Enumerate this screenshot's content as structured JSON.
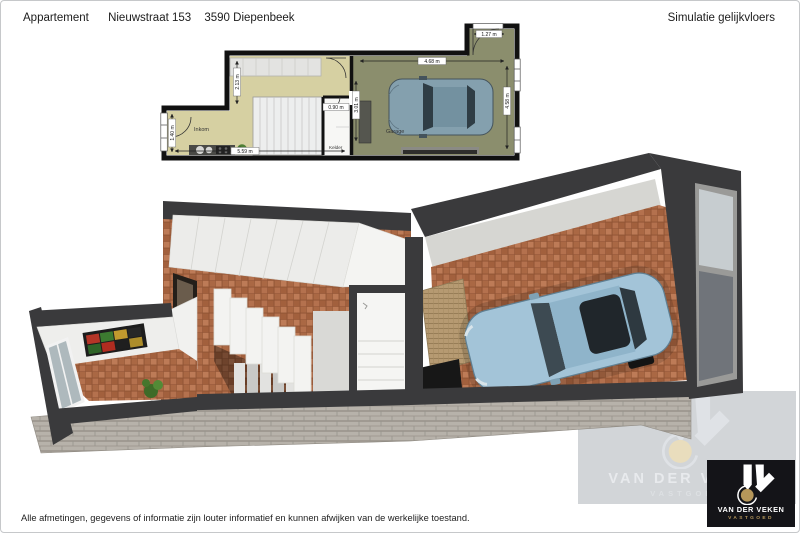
{
  "header": {
    "title": "Appartement",
    "address_street": "Nieuwstraat 153",
    "address_city": "3590 Diepenbeek",
    "simulation": "Simulatie gelijkvloers"
  },
  "plan2d": {
    "rooms": {
      "inkom": "Inkom",
      "kelder": "Kelder",
      "garage": "Garage"
    },
    "dims": {
      "inkom_depth": "2.13 m",
      "entry_width": "1.40 m",
      "inkom_length": "5.59 m",
      "kelder_width": "0.90 m",
      "garage_left_depth": "3.01 m",
      "garage_length": "4.68 m",
      "garage_door": "1.27 m",
      "garage_depth": "4.58 m"
    }
  },
  "branding": {
    "watermark": {
      "line1": "VAN DER VEKEN",
      "line2": "VASTGOED"
    },
    "logo": {
      "line1": "VAN DER VEKEN",
      "line2": "VASTGOED"
    }
  },
  "footer": {
    "disclaimer": "Alle afmetingen, gegevens of informatie zijn louter informatief en kunnen afwijken van de werkelijke toestand."
  },
  "colors": {
    "accent_gold": "#b6975a",
    "logo_bg": "#141418",
    "wall_dark": "#3a3a3c",
    "tile_terracotta": "#b2704e",
    "plan_inkom_floor": "#d6d0a2",
    "plan_garage_floor": "#8b8e6d",
    "watermark_bg": "#d2d5d8"
  }
}
